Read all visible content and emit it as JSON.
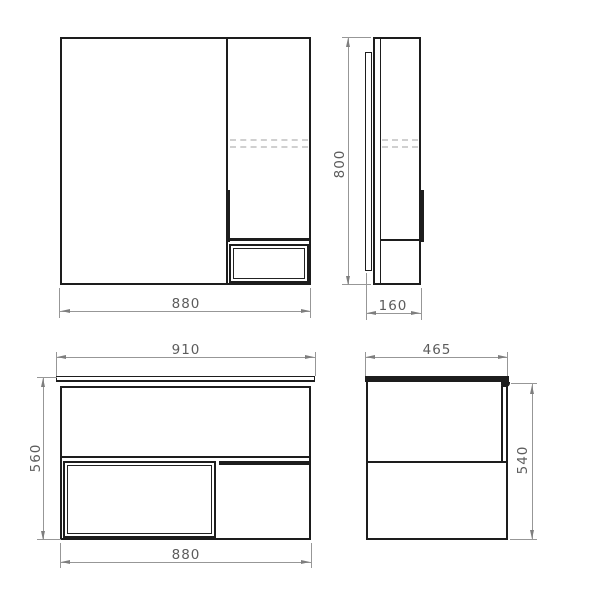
{
  "drawing": {
    "kind": "furniture-technical-drawing",
    "colors": {
      "background": "#ffffff",
      "object_line": "#1d1d1d",
      "dimension_line": "#979797",
      "dimension_text": "#5c5c5c",
      "hidden_shelf_line": "#d0d0d0"
    }
  },
  "views": {
    "mirror_front": {
      "name": "mirror-cabinet-front-view",
      "width": "880"
    },
    "mirror_side": {
      "name": "mirror-cabinet-side-view",
      "height": "800",
      "depth": "160"
    },
    "vanity_front": {
      "name": "vanity-front-view",
      "countertop_width": "910",
      "height": "560",
      "body_width": "880"
    },
    "vanity_side": {
      "name": "vanity-side-view",
      "depth": "465",
      "height": "540"
    }
  }
}
